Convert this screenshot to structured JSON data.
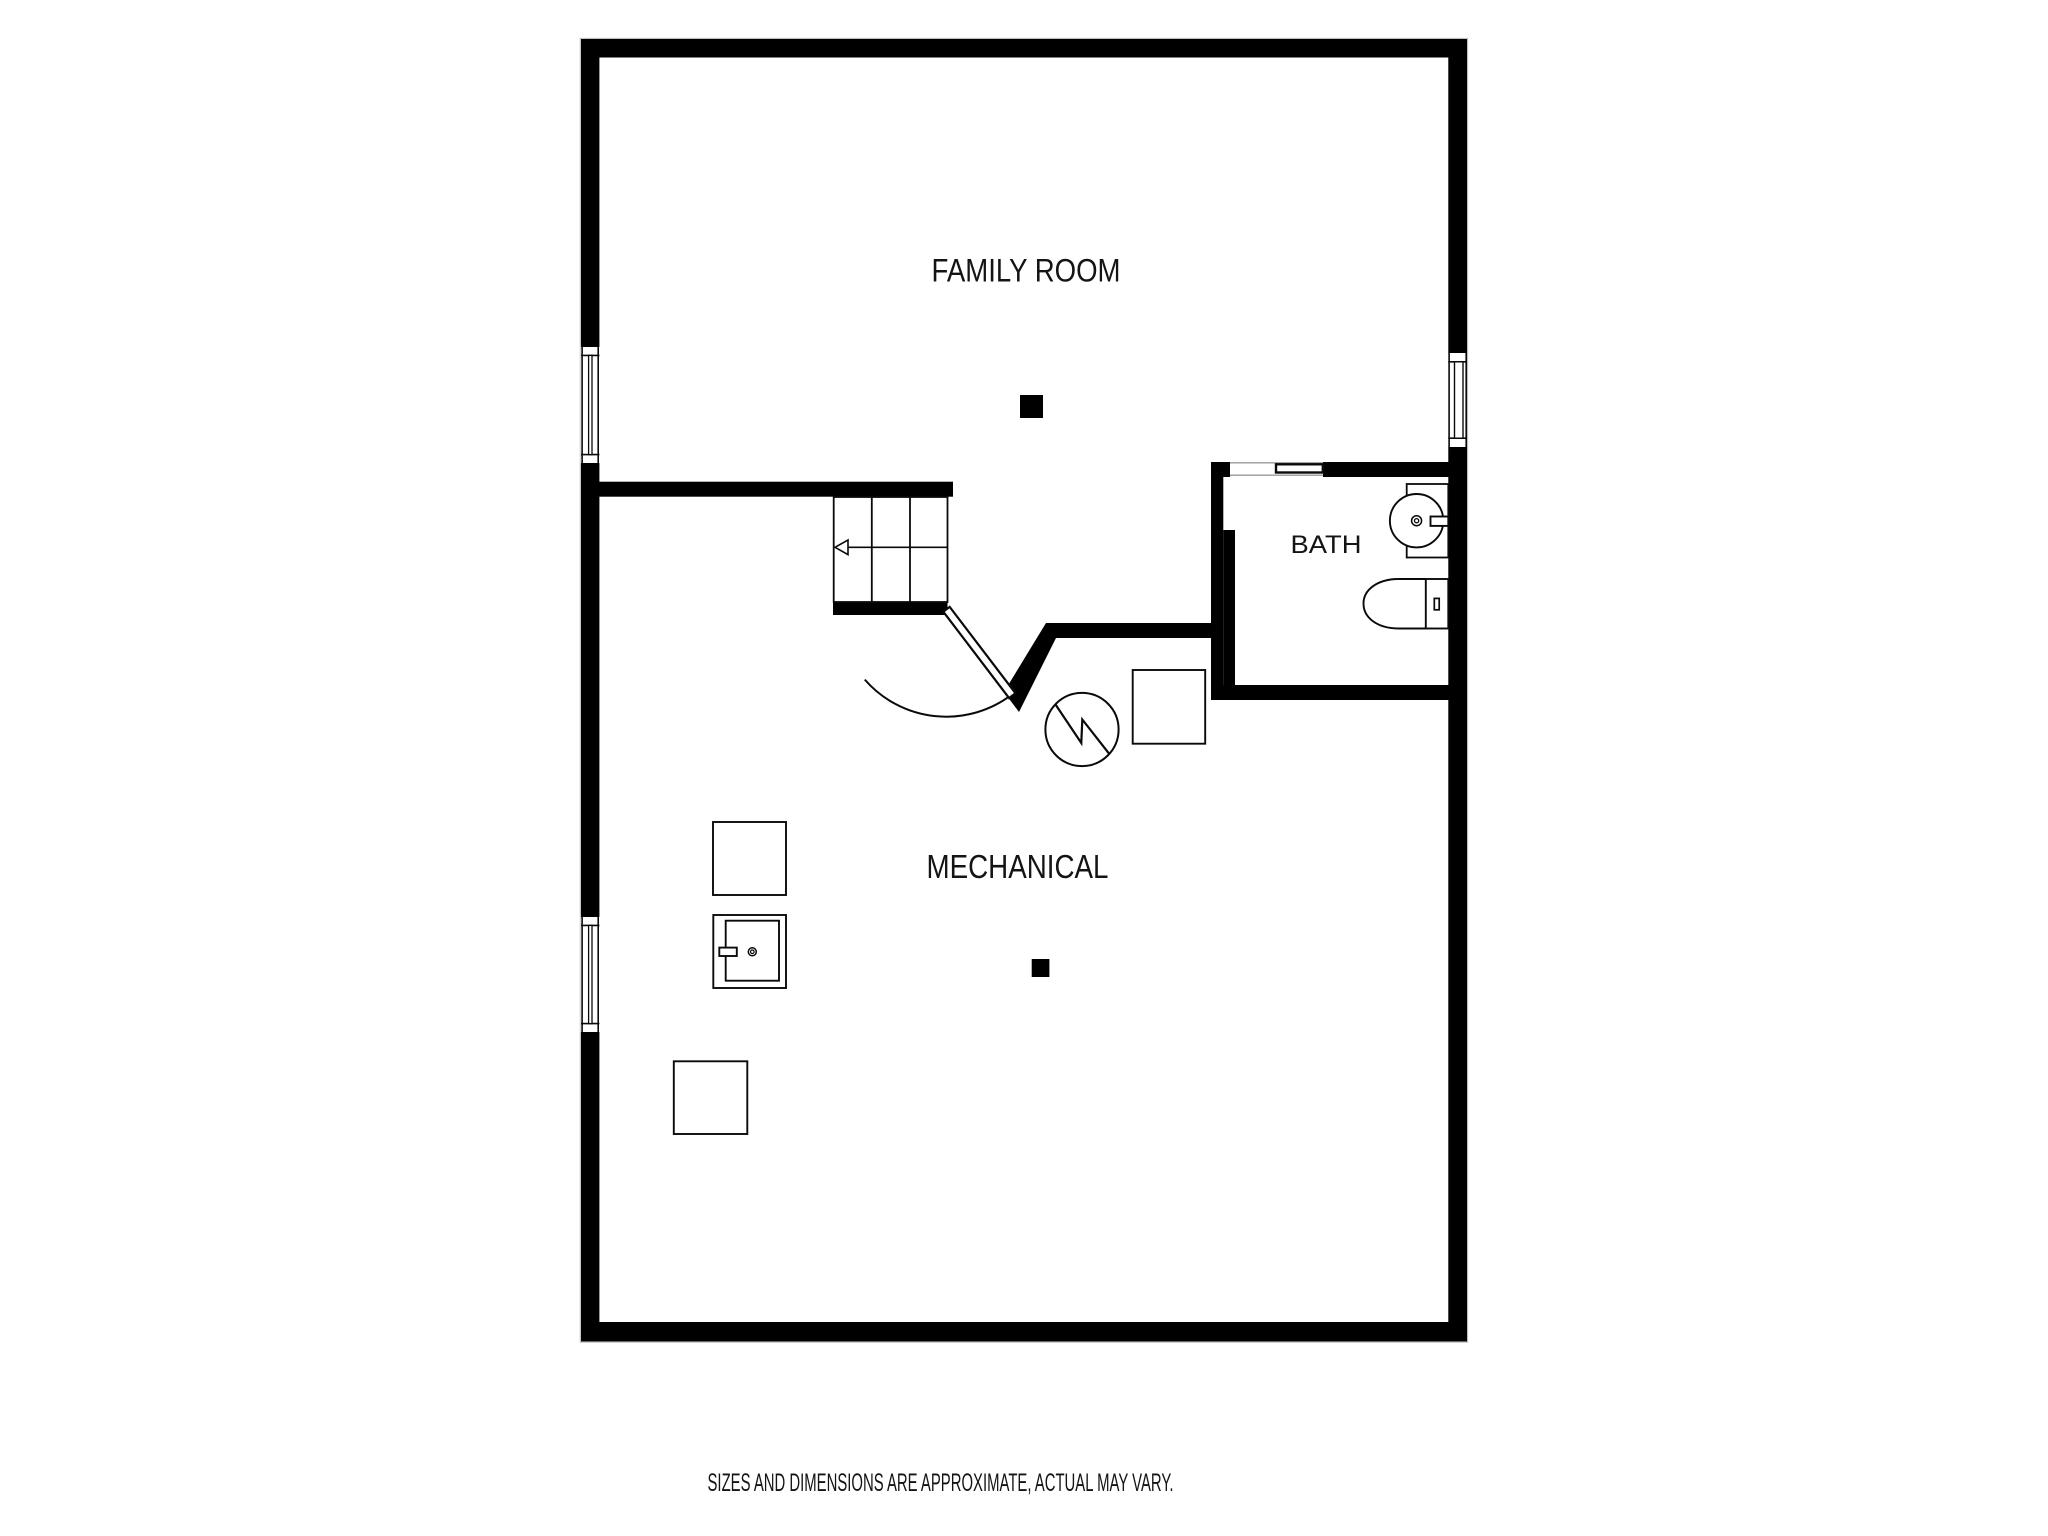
{
  "plan": {
    "rooms": [
      {
        "id": "family-room",
        "label": "FAMILY ROOM"
      },
      {
        "id": "bath",
        "label": "BATH"
      },
      {
        "id": "mechanical",
        "label": "MECHANICAL"
      }
    ],
    "footer": {
      "disclaimer": "SIZES AND DIMENSIONS ARE APPROXIMATE, ACTUAL MAY VARY."
    },
    "colors": {
      "wall": "#000000",
      "line": "#0a0a0a",
      "background": "#ffffff",
      "hairline": "#b8b8b8",
      "opening_line": "#9a9a9a"
    }
  }
}
